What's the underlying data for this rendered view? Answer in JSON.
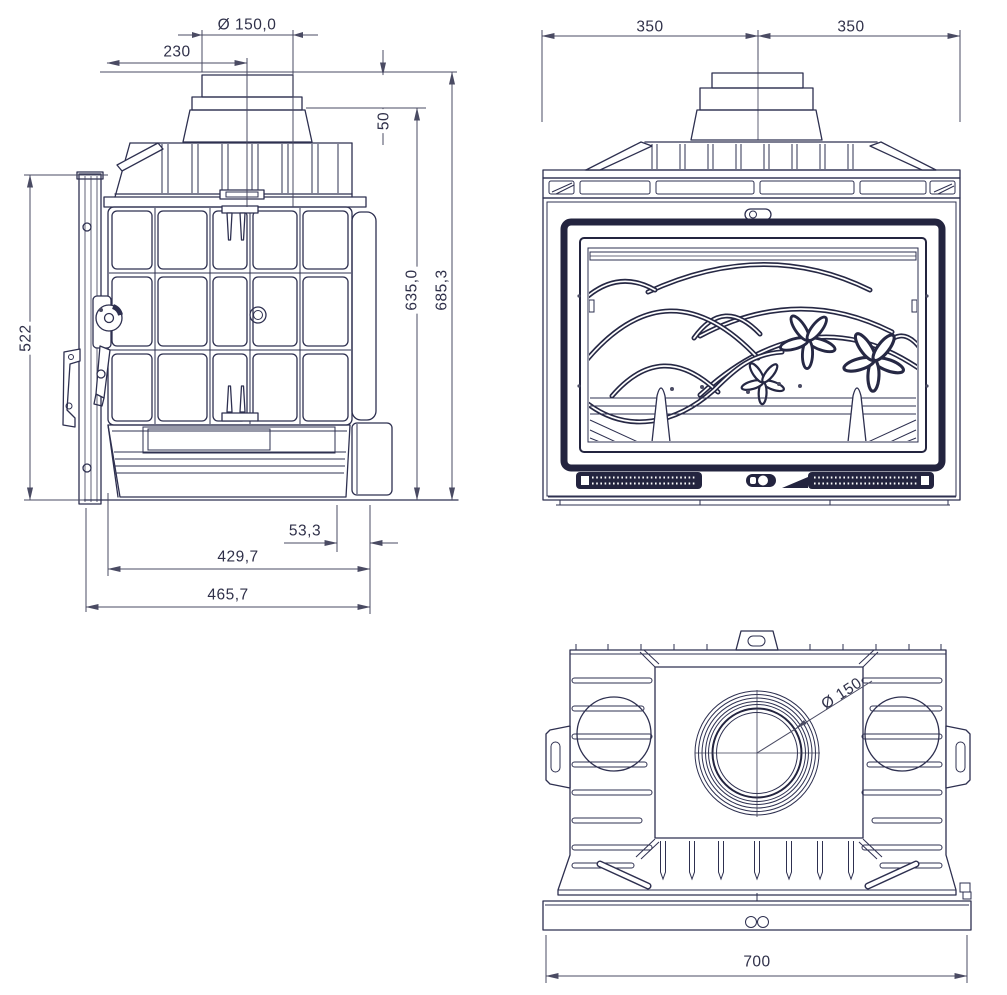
{
  "page": {
    "background": "#ffffff",
    "line_color": "#2e3050",
    "accent_dark": "#23243f"
  },
  "views": {
    "side": {
      "name": "side-view",
      "dims": {
        "pipe_diameter": "Ø 150,0",
        "pipe_center_offset": "230",
        "collar_height": "50",
        "body_height": "635,0",
        "total_height": "685,3",
        "door_height": "522",
        "rear_overhang": "53,3",
        "body_depth": "429,7",
        "total_depth": "465,7"
      }
    },
    "front": {
      "name": "front-view",
      "dims": {
        "left_half_width": "350",
        "right_half_width": "350"
      }
    },
    "top": {
      "name": "top-view",
      "dims": {
        "flue_diameter": "Ø 150",
        "total_width": "700"
      }
    }
  }
}
